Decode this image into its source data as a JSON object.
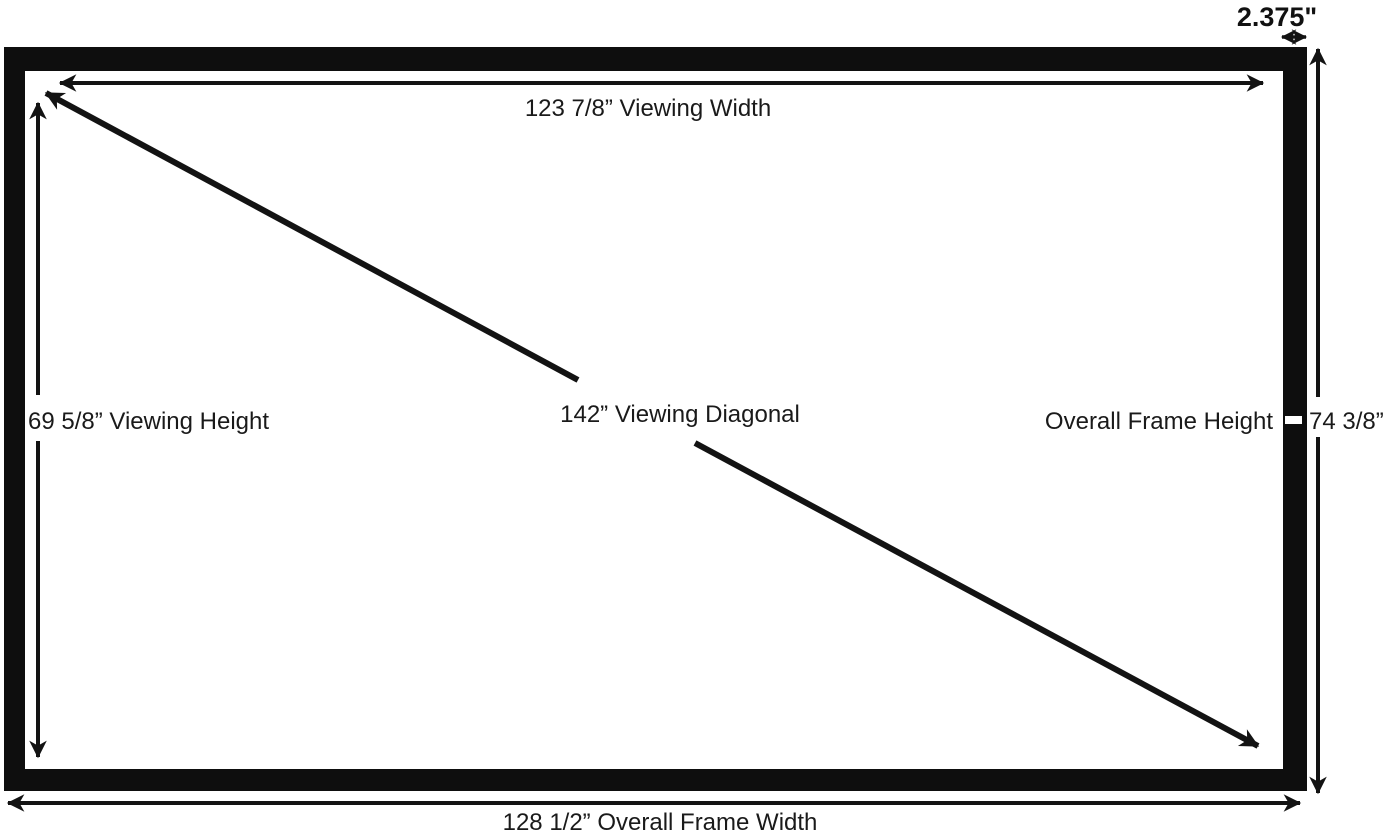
{
  "diagram": {
    "type": "projection-screen-dimension-diagram",
    "labels": {
      "border_width": "2.375\"",
      "viewing_width": "123 7/8” Viewing Width",
      "viewing_height": "69 5/8” Viewing Height",
      "viewing_diagonal": "142” Viewing Diagonal",
      "frame_height_label": "Overall Frame Height",
      "frame_height_value": "74 3/8”",
      "frame_width": "128 1/2” Overall Frame Width"
    },
    "measurements": {
      "viewing_width_in": "123 7/8",
      "viewing_height_in": "69 5/8",
      "viewing_diagonal_in": "142",
      "overall_frame_height_in": "74 3/8",
      "overall_frame_width_in": "128 1/2",
      "frame_border_in": "2.375"
    },
    "colors": {
      "frame": "#0e0e0e",
      "background": "#ffffff",
      "line": "#131313",
      "text": "#1a1a1a"
    }
  }
}
